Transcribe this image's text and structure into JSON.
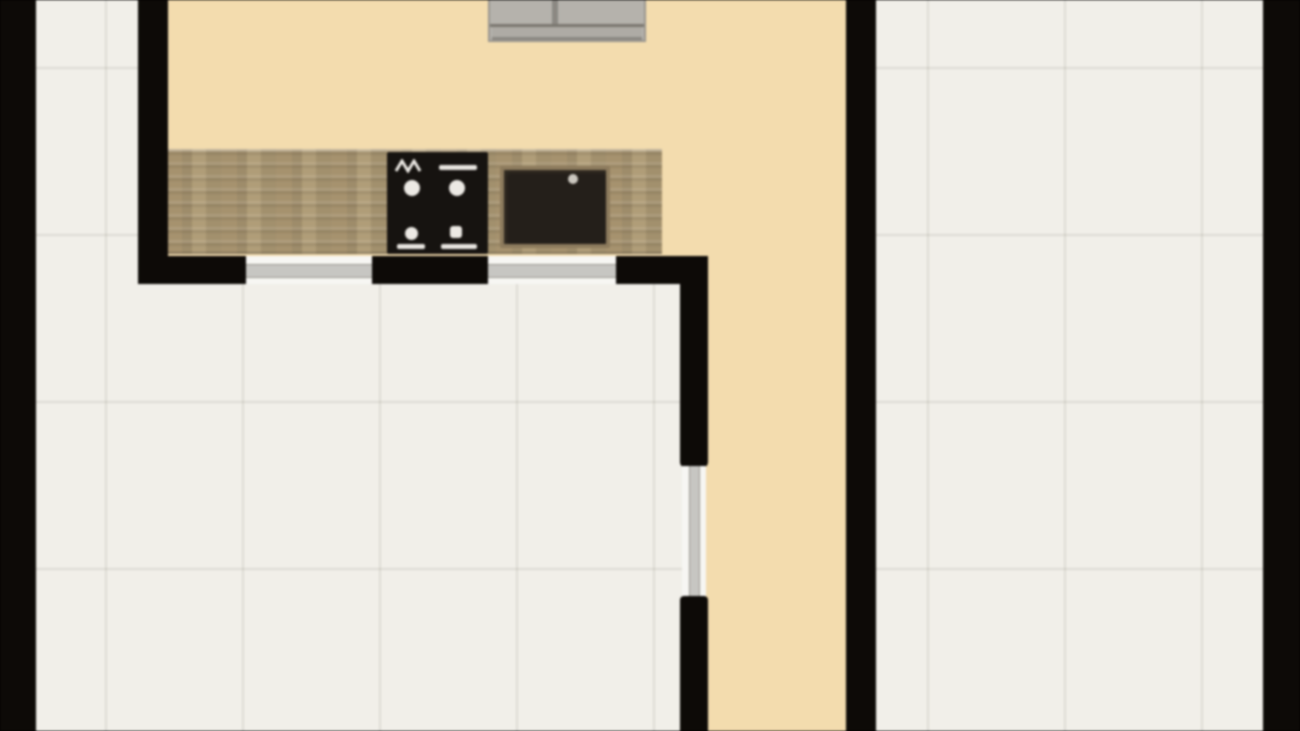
{
  "meta": {
    "type": "floor-plan",
    "description": "Top-down 2D rendered floor plan, no text labels visible",
    "has_text": false
  },
  "colors": {
    "wall": "#0d0a07",
    "kitchen_floor": "#f3dcae",
    "tile_floor": "#f1efe9",
    "tile_grout": "#e2dfd7",
    "counter_wood": "#a6926e",
    "stove": "#161310",
    "stove_marks": "#ece9e4",
    "sink": "#241f1a",
    "sink_rim": "#8d7b5d",
    "window_glass": "#c7c6c2",
    "window_frame": "#f7f6f3",
    "furniture": "#b5b2ac"
  },
  "rooms": [
    {
      "name": "kitchen",
      "floor": "tan",
      "position": "upper-left of tan zone"
    },
    {
      "name": "hallway",
      "floor": "tan",
      "position": "vertical strip right of interior wall"
    },
    {
      "name": "room-left",
      "floor": "white-tile",
      "position": "lower-left"
    },
    {
      "name": "room-right",
      "floor": "white-tile",
      "position": "right side"
    }
  ],
  "fixtures": [
    {
      "name": "kitchen-counter",
      "material": "wood",
      "location": "along bottom wall of kitchen"
    },
    {
      "name": "stove",
      "burners": 4,
      "location": "center of counter"
    },
    {
      "name": "sink",
      "basins": 1,
      "location": "right of stove on counter"
    },
    {
      "name": "furniture-top",
      "note": "gray item cropped by top edge of image"
    }
  ],
  "openings": [
    {
      "name": "window-1",
      "orientation": "horizontal",
      "wall": "kitchen-bottom"
    },
    {
      "name": "window-2",
      "orientation": "horizontal",
      "wall": "kitchen-bottom"
    },
    {
      "name": "window-3",
      "orientation": "vertical",
      "wall": "interior"
    }
  ],
  "walls": [
    "outer-left",
    "outer-right",
    "kitchen-left",
    "kitchen-right-full-height",
    "kitchen-bottom-segmented",
    "interior-vertical-segmented"
  ]
}
